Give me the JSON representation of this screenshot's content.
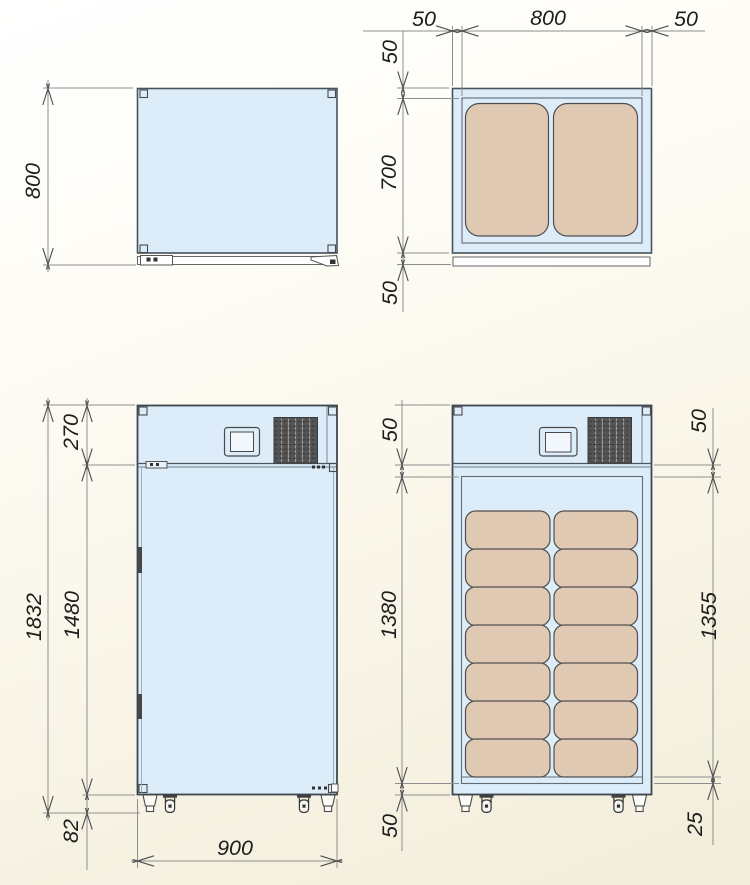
{
  "drawing": {
    "type": "technical-drawing",
    "description": "Four-view dimensioned drawing of an insulated cabinet with casters, top compartment with display and vent grille, and interior content blocks",
    "views": {
      "side": {
        "label": "side-view-top",
        "dims": {
          "depth": "800"
        }
      },
      "plan": {
        "label": "plan-view",
        "dims": {
          "wall_left": "50",
          "inner_width": "800",
          "wall_right": "50",
          "wall_back": "50",
          "inner_depth": "700",
          "door_thickness": "50"
        }
      },
      "front": {
        "label": "front-view-closed",
        "dims": {
          "top_section": "270",
          "door_height": "1480",
          "overall_height": "1832",
          "base_height": "82",
          "overall_width": "900"
        }
      },
      "front_open": {
        "label": "front-view-open",
        "dims": {
          "wall_top": "50",
          "interior_height": "1380",
          "wall_bottom": "50",
          "clearance_top": "50",
          "usable_height": "1355",
          "floor_plate": "25"
        }
      }
    },
    "colors": {
      "body_fill": "#dcedf9",
      "liner_fill": "#e4f1fb",
      "content_fill": "#e0c9b2",
      "strip_fill": "#ffffff",
      "grille_fill": "#545454",
      "outline": "#46525c",
      "dim_line": "#8e8e8e",
      "text": "#1d1d1d"
    }
  }
}
